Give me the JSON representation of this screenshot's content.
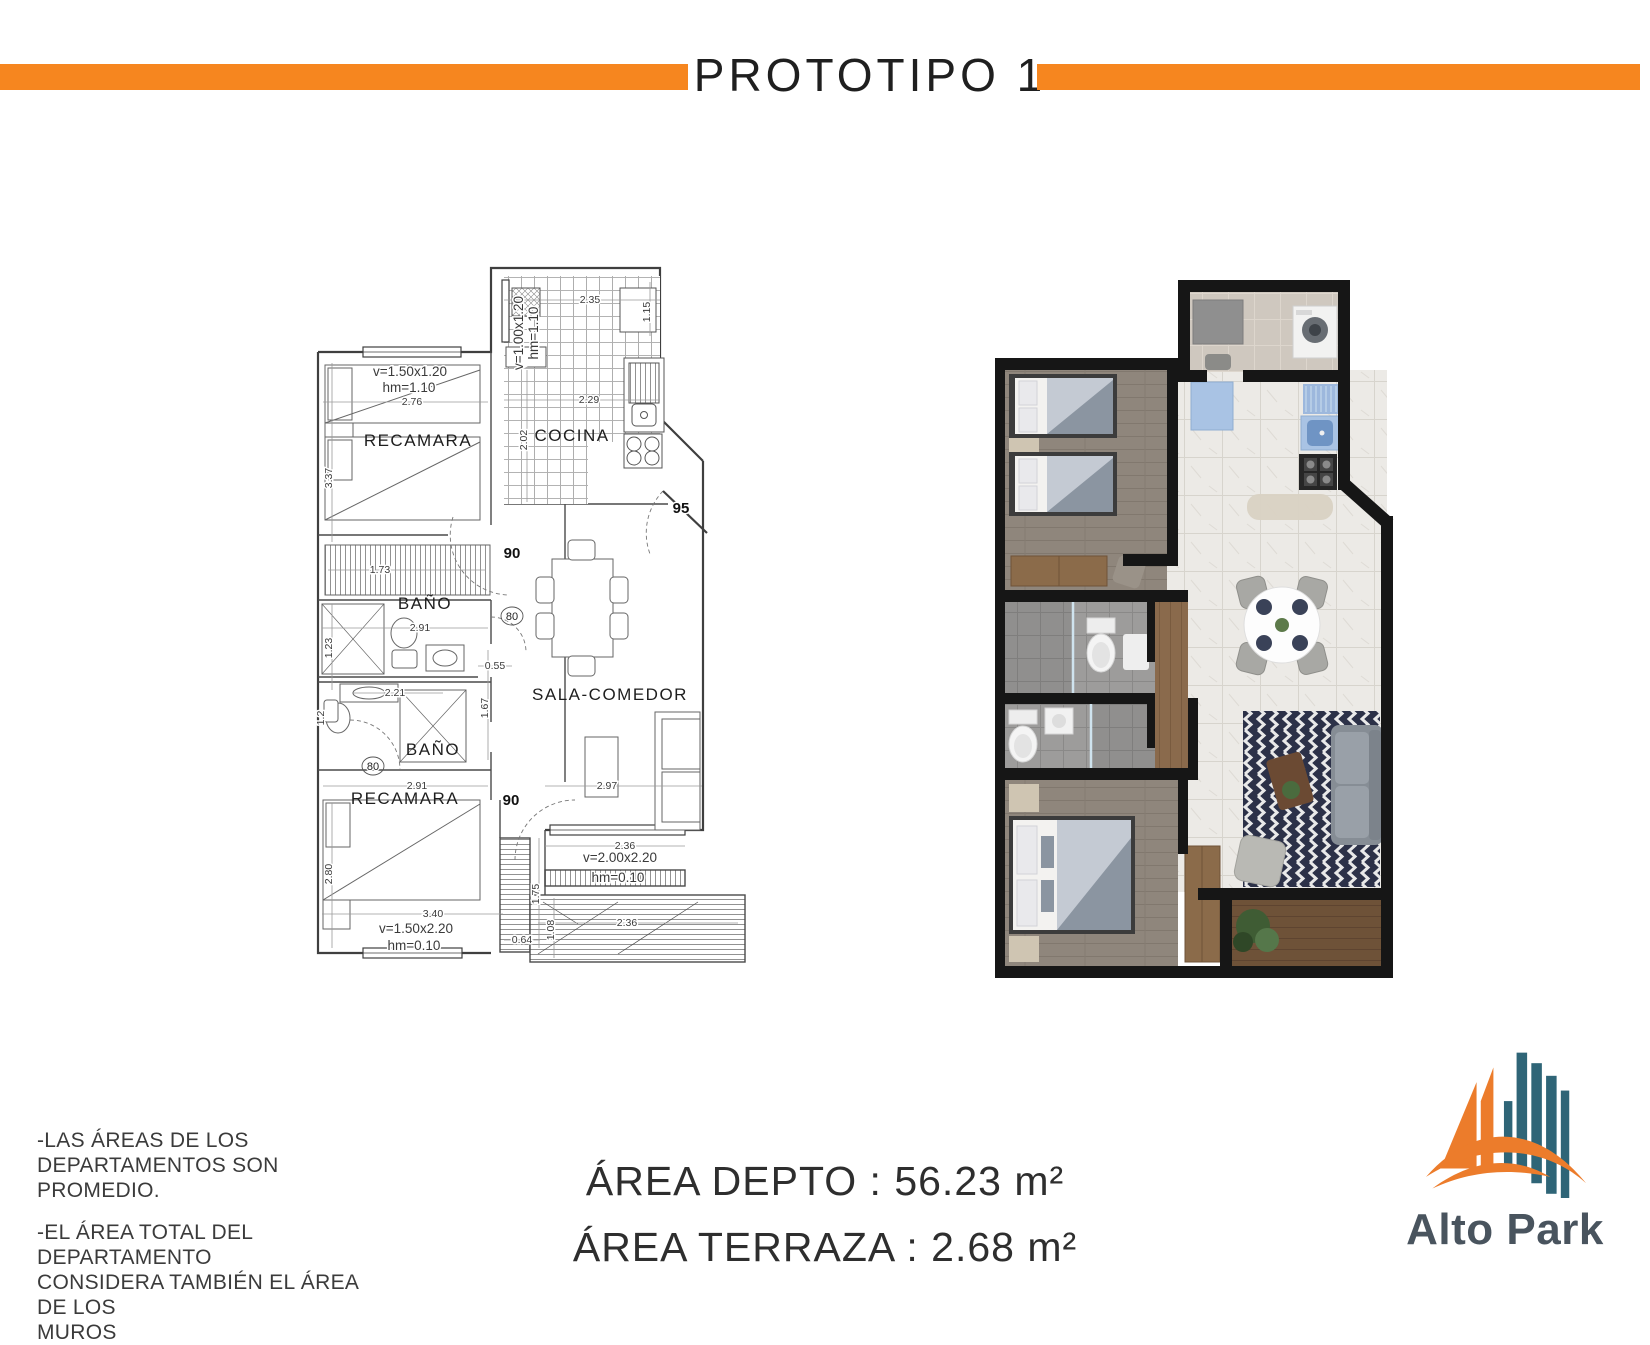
{
  "header": {
    "title": "PROTOTIPO 1"
  },
  "plan": {
    "room_recamara1": "RECAMARA",
    "room_cocina": "COCINA",
    "room_bano1": "BAÑO",
    "room_bano2": "BAÑO",
    "room_recamara2": "RECAMARA",
    "room_sala": "SALA-COMEDOR",
    "win1_l1": "v=1.50x1.20",
    "win1_l2": "hm=1.10",
    "win2_l1": "v=1.00x1.20",
    "win2_l2": "hm=1.10",
    "win3_l1": "v=2.00x2.20",
    "win3_l2": "hm=0.10",
    "win4_l1": "v=1.50x2.20",
    "win4_l2": "hm=0.10",
    "dim_276": "2.76",
    "dim_337": "3.37",
    "dim_173": "1.73",
    "dim_235": "2.35",
    "dim_115": "1.15",
    "dim_229": "2.29",
    "dim_202": "2.02",
    "dim_291a": "2.91",
    "dim_123": "1.23",
    "dim_055": "0.55",
    "dim_221": "2.21",
    "dim_12": "1.2",
    "dim_167": "1.67",
    "dim_291b": "2.91",
    "dim_297": "2.97",
    "dim_280": "2.80",
    "dim_340": "3.40",
    "dim_064": "0.64",
    "dim_175": "1.75",
    "dim_236a": "2.36",
    "dim_236b": "2.36",
    "dim_108": "1.08",
    "door_90a": "90",
    "door_80a": "80",
    "door_80b": "80",
    "door_90b": "90",
    "door_95": "95"
  },
  "notes": {
    "lines": [
      "-LAS ÁREAS DE LOS",
      "DEPARTAMENTOS SON PROMEDIO.",
      "-EL ÁREA TOTAL DEL DEPARTAMENTO",
      "CONSIDERA TAMBIÉN EL ÁREA DE LOS",
      "MUROS"
    ]
  },
  "areas": {
    "depto": "ÁREA DEPTO : 56.23 m²",
    "terraza": "ÁREA TERRAZA : 2.68 m²"
  },
  "logo": {
    "name": "Alto Park"
  },
  "colors": {
    "accent_orange": "#F6861F",
    "logo_orange": "#EC7C2B",
    "logo_teal": "#2F6577",
    "logo_text": "#49545E",
    "wall_black": "#161616"
  }
}
